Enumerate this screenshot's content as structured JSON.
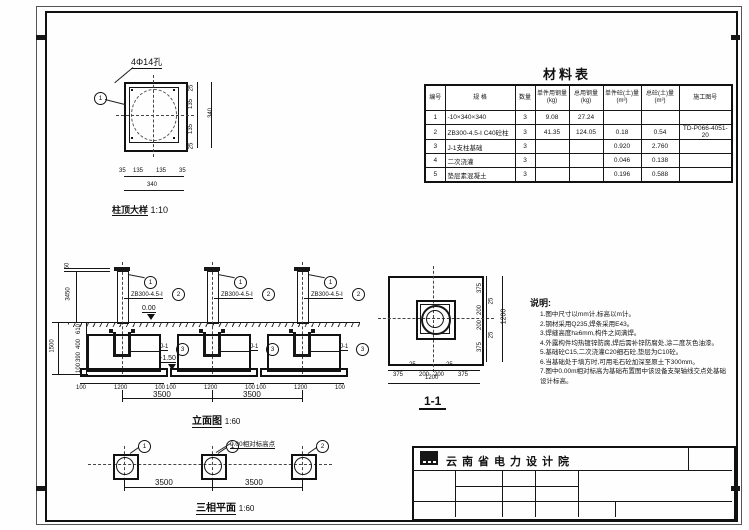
{
  "page": {
    "line_color": "#161616",
    "paper_color": "#ffffff"
  },
  "detail": {
    "title": "柱顶大样",
    "scale": "1:10",
    "hole_label": "4Φ14孔",
    "marker": "1",
    "dims_right": [
      "25",
      "135",
      "135",
      "25"
    ],
    "dim_right_total": "340",
    "dims_bottom": [
      "35",
      "135",
      "135",
      "35"
    ],
    "dim_bottom_total": "340"
  },
  "materials_table": {
    "title": "材料表",
    "headers": [
      "编号",
      "规  格",
      "数量",
      "单件用钢量(kg)",
      "总用钢量(kg)",
      "单件砼(土)量(m³)",
      "总砼(土)量(m³)",
      "施工图号"
    ],
    "rows": [
      [
        "1",
        "-10×340×340",
        "3",
        "9.08",
        "27.24",
        "",
        "",
        ""
      ],
      [
        "2",
        "ZB300-4.5-Ⅰ C40砼柱",
        "3",
        "41.35",
        "124.05",
        "0.18",
        "0.54",
        "TD-P066-4051-20"
      ],
      [
        "3",
        "J-1支柱基础",
        "3",
        "",
        "",
        "0.920",
        "2.760",
        ""
      ],
      [
        "4",
        "二次浇灌",
        "3",
        "",
        "",
        "0.046",
        "0.138",
        ""
      ],
      [
        "5",
        "垫层素混凝土",
        "3",
        "",
        "",
        "0.196",
        "0.588",
        ""
      ]
    ]
  },
  "elevation": {
    "title": "立面图",
    "scale": "1:60",
    "col_label": "ZB300-4.5-Ⅰ",
    "col_marker": "2",
    "top_marker": "1",
    "fdn_label": "J-1",
    "fdn_marker": "3",
    "level_top": "0.00",
    "level_bottom": "-1.50",
    "dim_top": "50",
    "dim_above": "3450",
    "dims_below": [
      "610",
      "400",
      "390",
      "100"
    ],
    "dim_below_total": "1500",
    "fdn_dims": [
      "100",
      "1200",
      "100"
    ],
    "spacing": [
      "3500",
      "3500"
    ]
  },
  "section": {
    "title": "1-1",
    "dims": [
      "375",
      "25",
      "200",
      "200",
      "25",
      "375"
    ],
    "total": "1200"
  },
  "notes": {
    "title": "说明:",
    "items": [
      "1.图中尺寸以mm计,标高以m计。",
      "2.钢材采用Q235,焊条采用E43。",
      "3.焊缝高度h≥6mm,构件之间满焊。",
      "4.外露构件均热镀锌防腐,焊后需补锌防腐处,涂二度灰色油漆。",
      "5.基础砼C15,二次浇灌C20细石砼,垫层为C10砼。",
      "6.当基础处于填方时,可用毛石砼加深至原土下300mm。",
      "7.图中0.00m相对标高为基础布置图中该设备支架轴线交点处基础设计标高。"
    ]
  },
  "plan": {
    "title": "三相平面",
    "scale": "1:60",
    "markers": [
      "1",
      "1",
      "2"
    ],
    "note": "0.00相对标高点",
    "spacing": [
      "3500",
      "3500"
    ]
  },
  "title_block": {
    "company": "云南省电力设计院"
  }
}
